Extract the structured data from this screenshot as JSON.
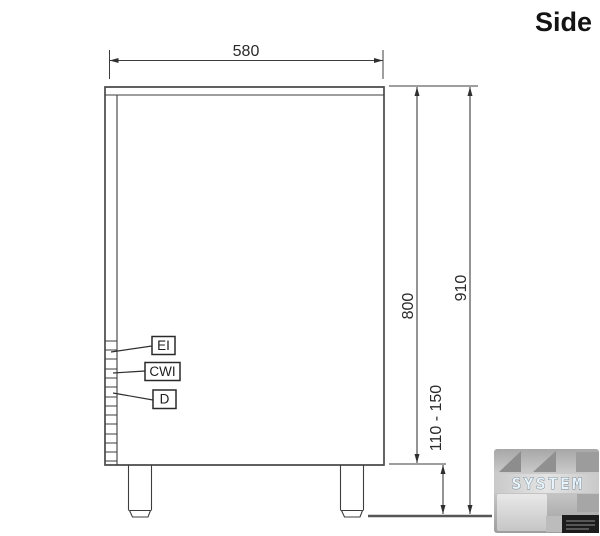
{
  "title": "Side",
  "dimensions": {
    "top_width": "580",
    "body_height": "800",
    "overall_height": "910",
    "leg_height_range": "110 - 150"
  },
  "connections": [
    {
      "label": "EI"
    },
    {
      "label": "CWI"
    },
    {
      "label": "D"
    }
  ],
  "watermark": {
    "brand": "SYSTEM"
  },
  "colors": {
    "line": "#3d3d3d",
    "text": "#2a2a2a",
    "floor": "#565656",
    "watermark_text": "#e7f4fc",
    "watermark_gray": "#bdbdbd"
  }
}
